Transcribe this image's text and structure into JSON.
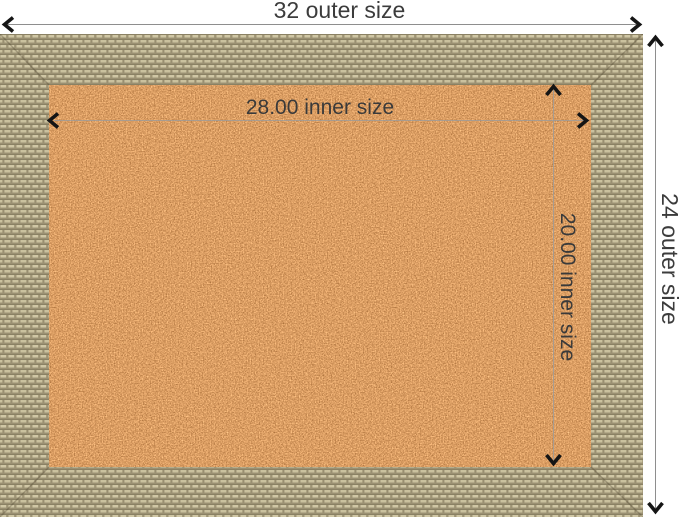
{
  "diagram": {
    "title": "framed cork board dimension diagram",
    "outer_width_label": "32 outer size",
    "outer_height_label": "24 outer size",
    "inner_width_label": "28.00 inner size",
    "inner_height_label": "20.00 inner size"
  },
  "icons": {
    "arrow_left": "chevron-left",
    "arrow_right": "chevron-right",
    "arrow_up": "chevron-up",
    "arrow_down": "chevron-down"
  },
  "colors": {
    "background": "#ffffff",
    "cork_surface": "#d59e63",
    "frame_weave": "#b3a988",
    "dimension_line": "#8e8e8e",
    "arrow": "#151515",
    "label_text": "#3c3c3c"
  }
}
